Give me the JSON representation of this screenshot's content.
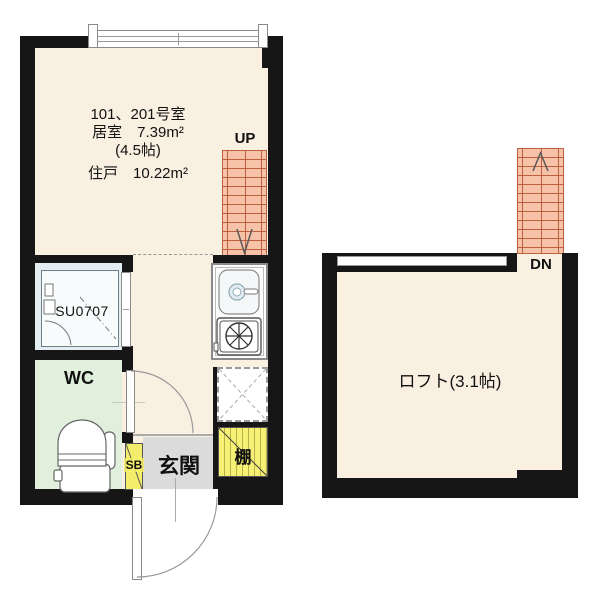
{
  "left_plan": {
    "unit_text": {
      "line1": "101、201号室",
      "line2": "居室　7.39m²",
      "line3": "(4.5帖)",
      "line4": "住戸　10.22m²"
    },
    "stairs_label": "UP",
    "bath_unit_label": "SU0707",
    "wc_label": "WC",
    "shoebox_label": "SB",
    "entrance_label": "玄関",
    "shelf_label": "棚"
  },
  "right_plan": {
    "stairs_label": "DN",
    "loft_label": "ロフト(3.1帖)"
  },
  "colors": {
    "wall": "#161616",
    "room_floor": "#faf0e2",
    "stairs_fill": "#f6c3a9",
    "stairs_lines": "#bb5f3f",
    "bathroom_floor": "#e2eef2",
    "wc_floor": "#e0f0dc",
    "entrance_floor": "#dbdbdb",
    "shelf_yellow": "#f6f075",
    "shoebox_yellow": "#f4ed6b"
  }
}
